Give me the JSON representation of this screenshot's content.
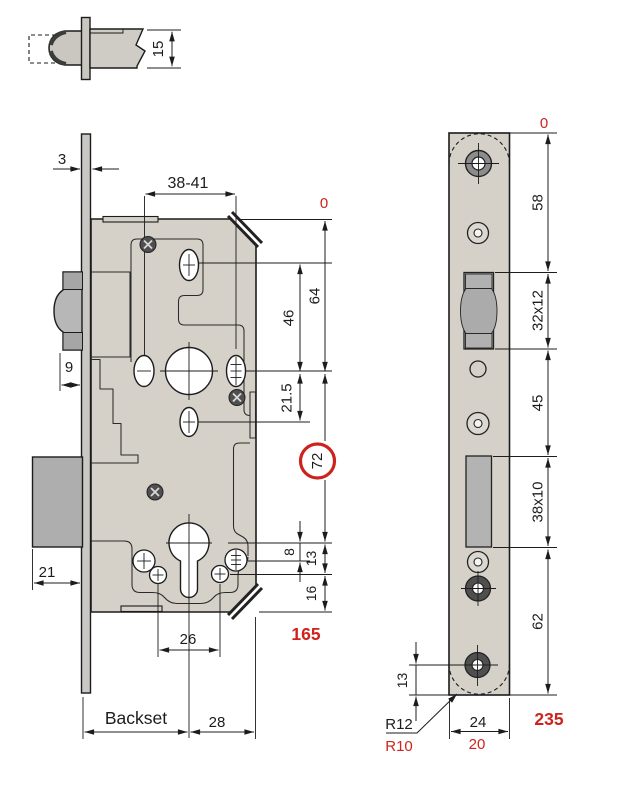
{
  "colors": {
    "accent_red": "#cc241d",
    "case_fill": "#d5d1c8",
    "strip_fill": "#c9c8c5",
    "metal_gray": "#b7b7b7",
    "line": "#1c1c1c"
  },
  "latch_detail": {
    "height": "15"
  },
  "lock_case": {
    "faceplate_thickness": "3",
    "top_screw_span": "38-41",
    "datum": "0",
    "spindle_depth": "64",
    "top_hole_depth": "46",
    "below_spindle": "21.5",
    "spindle_to_cylinder": "72",
    "cyl_offset_a": "8",
    "cyl_offset_b": "13",
    "bottom_margin": "16",
    "case_height": "165",
    "latch_projection": "9",
    "deadbolt_projection": "21",
    "lower_screw_span": "26",
    "backset": "Backset",
    "case_depth_behind": "28"
  },
  "faceplate": {
    "datum": "0",
    "seg_top": "58",
    "latch_cutout": "32x12",
    "seg_mid": "45",
    "bolt_cutout": "38x10",
    "seg_bottom": "62",
    "screw_to_end": "13",
    "corner_radius": "R12",
    "corner_radius_alt": "R10",
    "width": "24",
    "width_alt": "20",
    "length": "235"
  }
}
